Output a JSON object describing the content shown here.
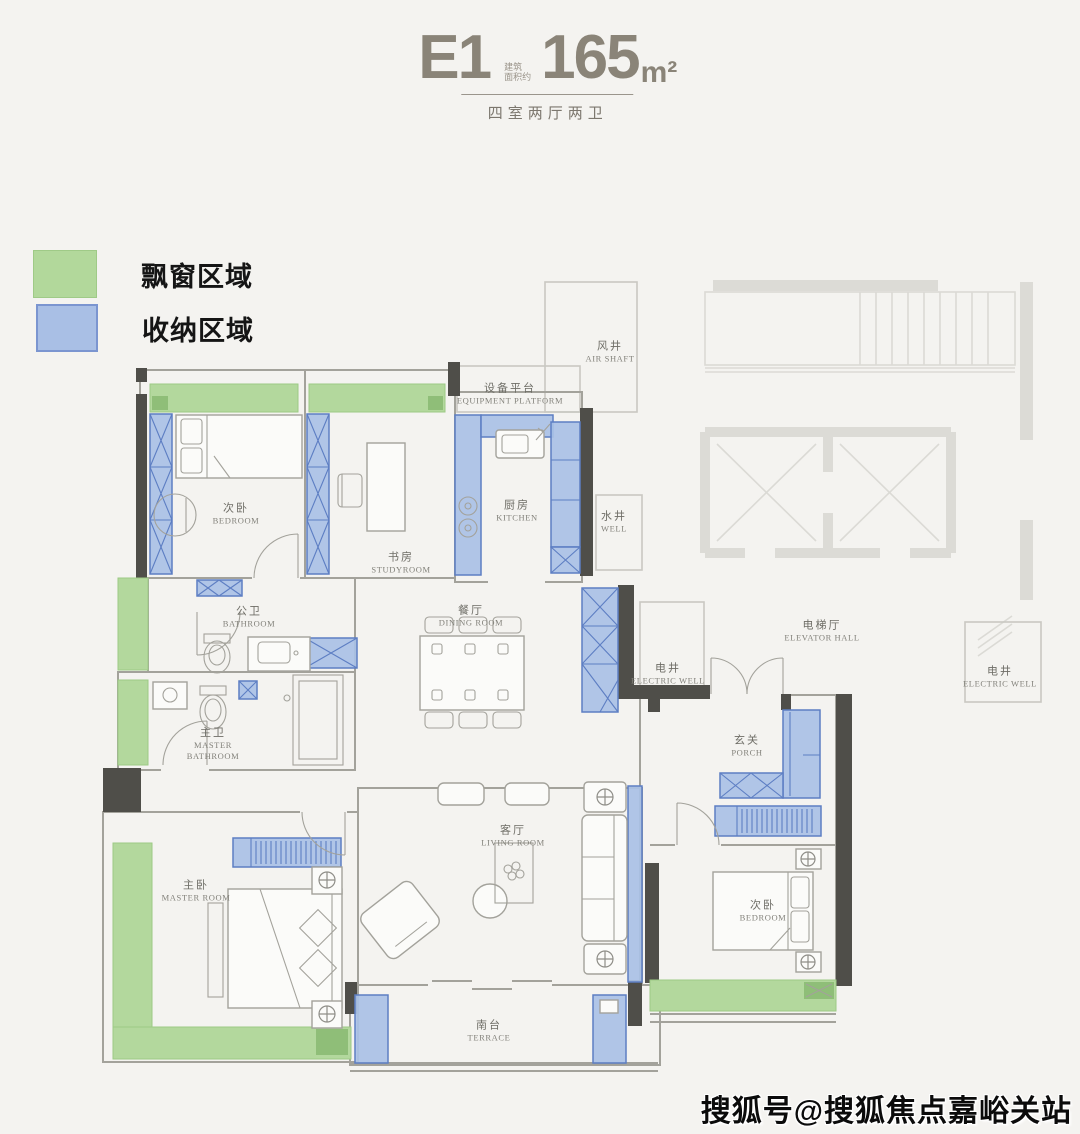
{
  "header": {
    "unit_code": "E1",
    "area_note_line1": "建筑",
    "area_note_line2": "面积约",
    "area_value": "165",
    "area_unit": "m²",
    "subtitle": "四室两厅两卫"
  },
  "legend": {
    "bay_window": {
      "label": "飘窗区域",
      "color": "#b2d89b"
    },
    "storage": {
      "label": "收纳区域",
      "color": "#a9bfe5"
    }
  },
  "rooms": {
    "bedroom_top": {
      "zh": "次卧",
      "en": "BEDROOM"
    },
    "studyroom": {
      "zh": "书房",
      "en": "STUDYROOM"
    },
    "kitchen": {
      "zh": "厨房",
      "en": "KITCHEN"
    },
    "equipment_platform": {
      "zh": "设备平台",
      "en": "EQUIPMENT PLATFORM"
    },
    "air_shaft": {
      "zh": "风井",
      "en": "AIR SHAFT"
    },
    "water_well": {
      "zh": "水井",
      "en": "WELL"
    },
    "bathroom": {
      "zh": "公卫",
      "en": "BATHROOM"
    },
    "master_bathroom": {
      "zh": "主卫",
      "en": "MASTER BATHROOM"
    },
    "dining_room": {
      "zh": "餐厅",
      "en": "DINING ROOM"
    },
    "electric_well_left": {
      "zh": "电井",
      "en": "ELECTRIC WELL"
    },
    "elevator_hall": {
      "zh": "电梯厅",
      "en": "ELEVATOR HALL"
    },
    "electric_well_right": {
      "zh": "电井",
      "en": "ELECTRIC WELL"
    },
    "porch": {
      "zh": "玄关",
      "en": "PORCH"
    },
    "living_room": {
      "zh": "客厅",
      "en": "LIVING ROOM"
    },
    "master_room": {
      "zh": "主卧",
      "en": "MASTER ROOM"
    },
    "bedroom_right": {
      "zh": "次卧",
      "en": "BEDROOM"
    },
    "terrace": {
      "zh": "南台",
      "en": "TERRACE"
    }
  },
  "watermark": "搜狐号@搜狐焦点嘉峪关站",
  "colors": {
    "background": "#f4f3f0",
    "bay_window_fill": "#b2d89b",
    "bay_window_dark": "#8fbe78",
    "storage_fill": "#a9c1e6",
    "storage_border": "#5d7ec3",
    "wall_dark": "#4f4e49",
    "wall_line": "#a3a29b",
    "title_gray": "#8a8478"
  }
}
